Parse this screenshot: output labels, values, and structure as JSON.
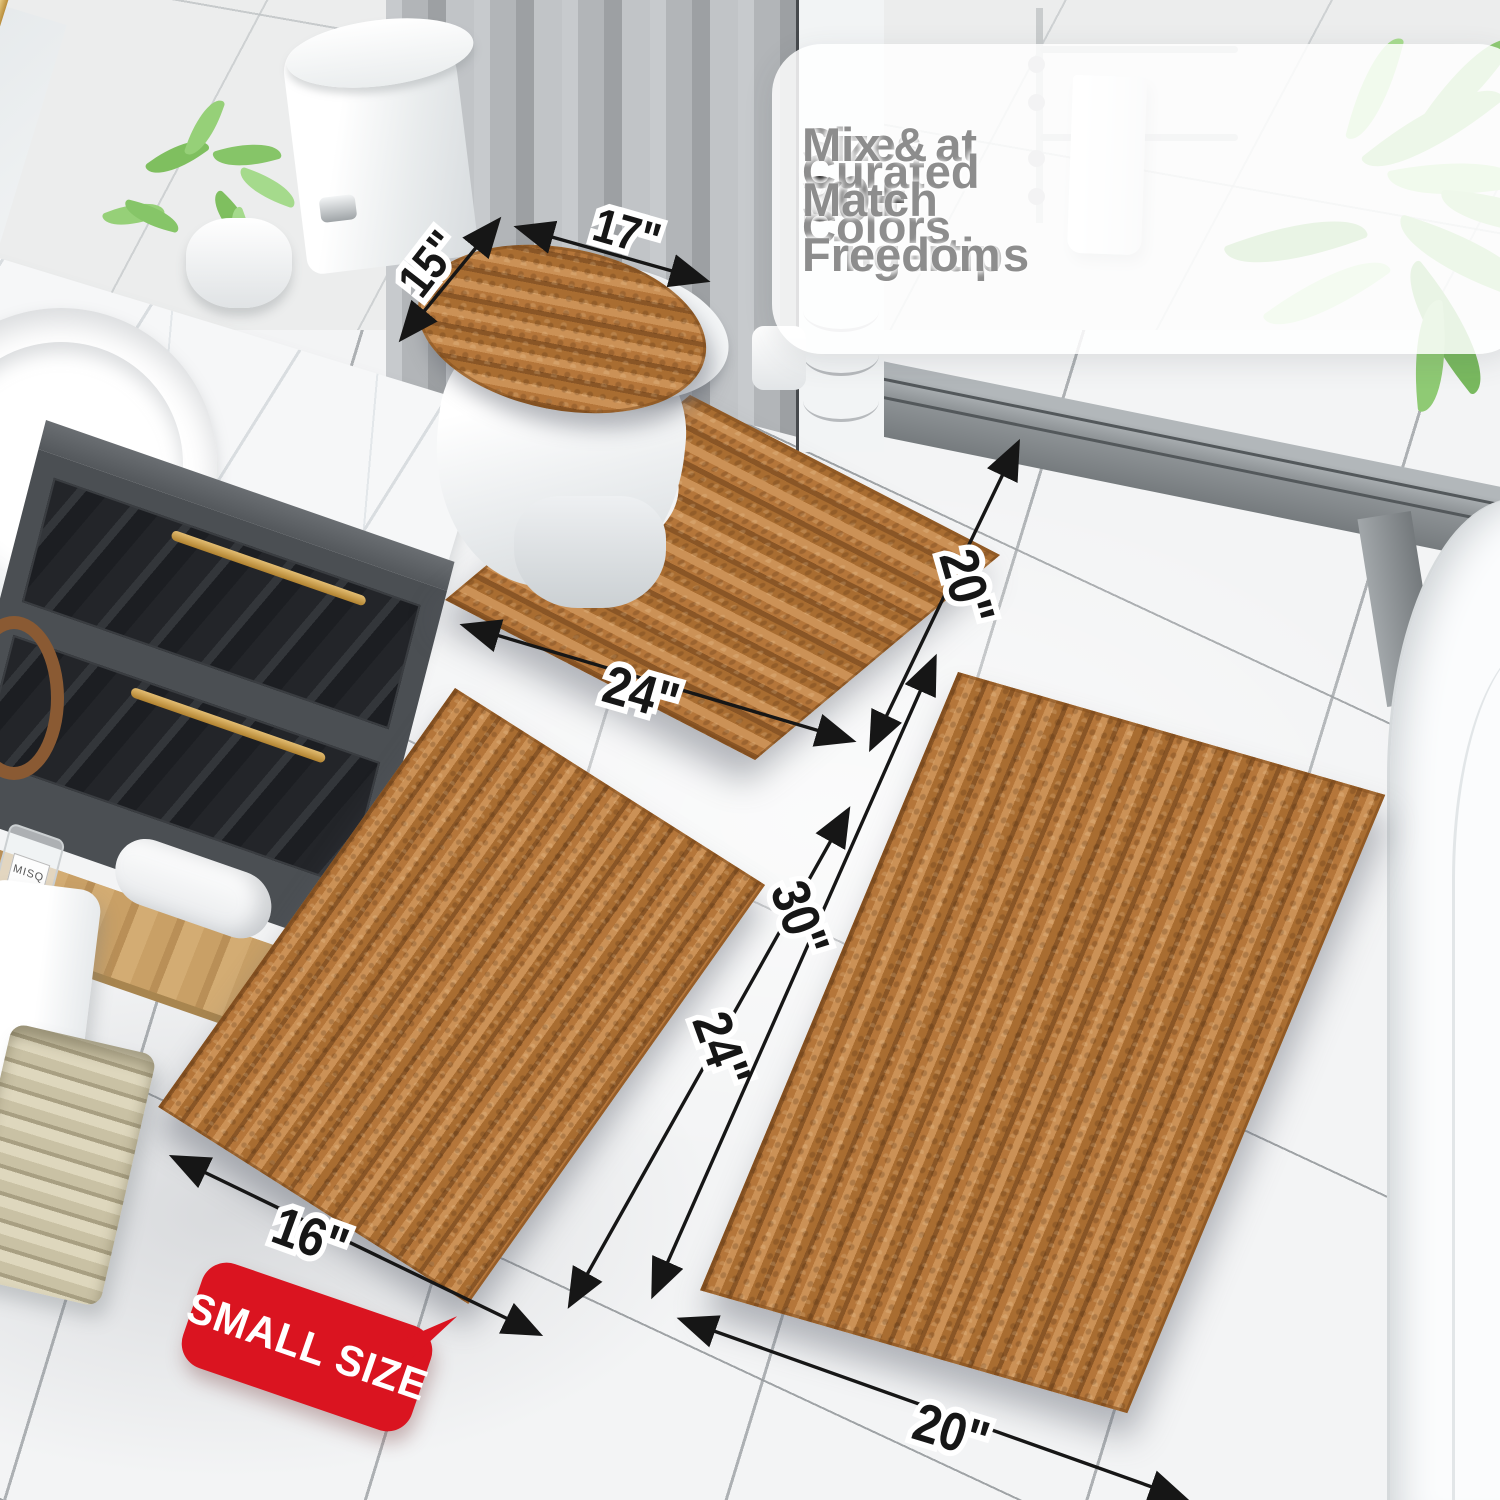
{
  "info_panel": {
    "check_icon": "✓",
    "features": [
      {
        "stat": "20+",
        "label": "Sizes at Your Fingertips"
      },
      {
        "stat": "30+",
        "label": "Curated Colors"
      },
      {
        "stat": "",
        "label": "Mix & Match Freedom"
      }
    ]
  },
  "dimension_labels": {
    "lid_width": "15\"",
    "lid_length": "17\"",
    "contour_length": "24\"",
    "contour_depth": "20\"",
    "small_length": "24\"",
    "small_width": "16\"",
    "large_length": "30\"",
    "large_width": "20\"",
    "badge": "SMALL SIZE"
  },
  "decor": {
    "perfume_bottle_label": "MISQ"
  },
  "colors": {
    "rug": "#b5763a",
    "rug_highlight": "#cb9156",
    "rug_shadow": "#8a5626",
    "badge_red": "#da1420",
    "dimension_text": "#161616",
    "feature_gray": "#8d8d8d",
    "stat_black": "#1e1e1e",
    "floor": "#f3f4f5",
    "grout": "#c6c9cb",
    "wall": "#eceded",
    "curtain_gray": "#b7babd",
    "curb_stone": "#8f9497",
    "vanity_gray": "#4b4f53",
    "marble_white": "#f6f7f8",
    "gold": "#c59a4a",
    "wood": "#c89e63",
    "leaf_green": "#8cc973"
  }
}
